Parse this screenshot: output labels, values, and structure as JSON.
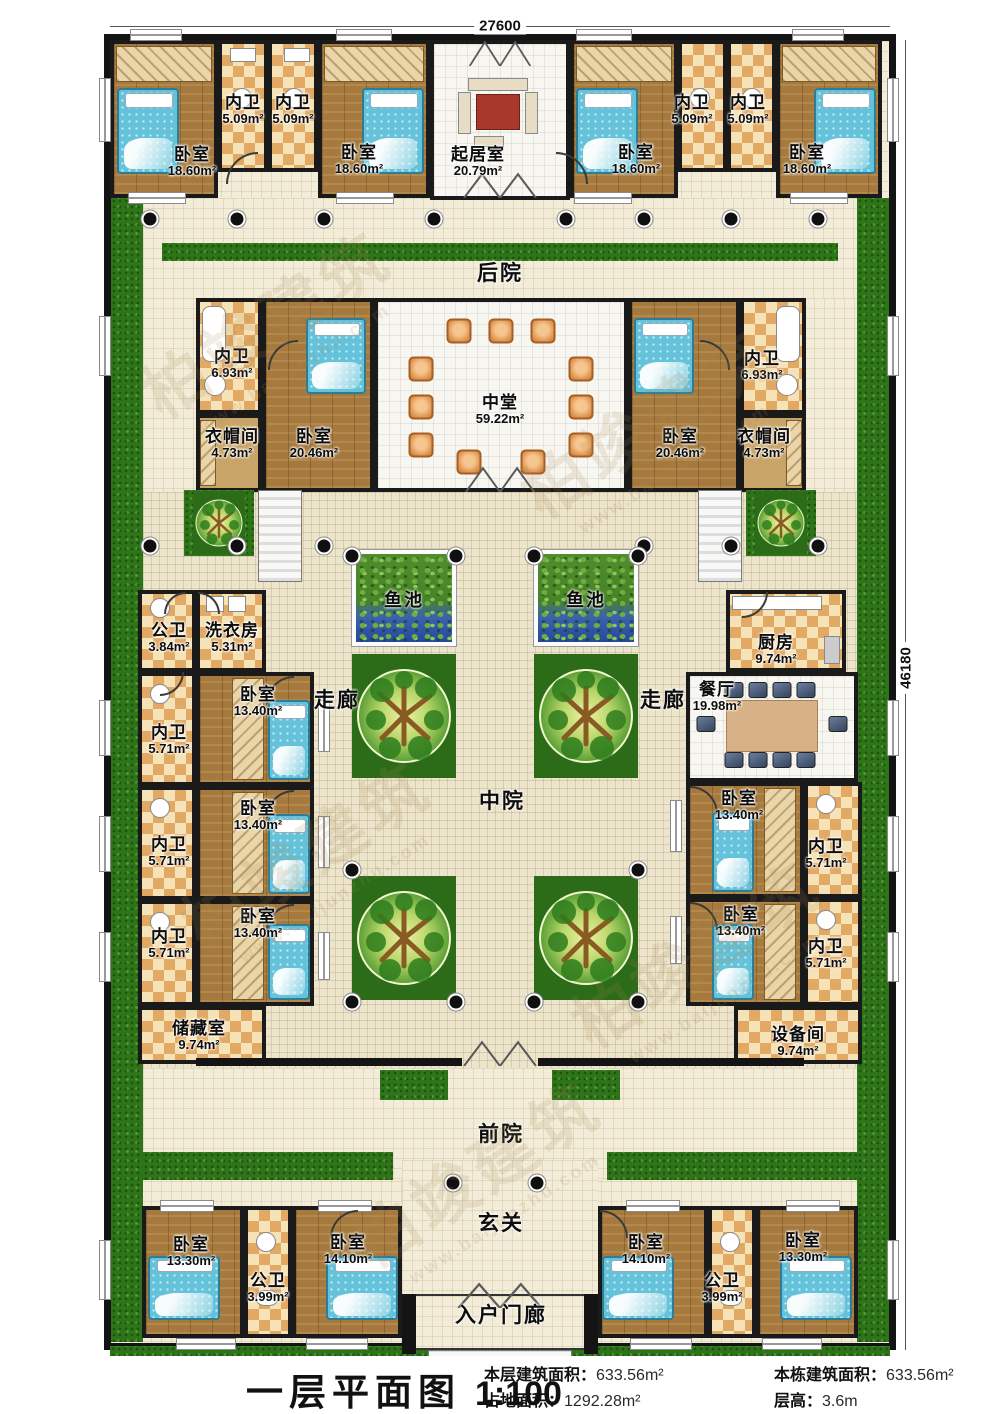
{
  "title": {
    "name": "一层平面图",
    "scale": "1:100"
  },
  "stats": [
    {
      "label": "本层建筑面积：",
      "value": "633.56m²"
    },
    {
      "label": "本栋建筑面积：",
      "value": "633.56m²"
    },
    {
      "label": "占地面积：",
      "value": "1292.28m²"
    },
    {
      "label": "层高：",
      "value": "3.6m"
    }
  ],
  "dimensions": {
    "top": "27600",
    "right": "46180"
  },
  "zones": {
    "backyard": "后院",
    "courtyard": "中院",
    "frontyard": "前院",
    "foyer": "玄关",
    "entry_porch": "入户门廊",
    "corridor_left": "走廊",
    "corridor_right": "走廊",
    "pond_left": "鱼池",
    "pond_right": "鱼池"
  },
  "watermark": {
    "brand": "柏竣建筑",
    "site": "www.baijunzhu.com"
  },
  "rooms": [
    {
      "name": "卧室",
      "area": "18.60m²"
    },
    {
      "name": "内卫",
      "area": "5.09m²"
    },
    {
      "name": "内卫",
      "area": "5.09m²"
    },
    {
      "name": "卧室",
      "area": "18.60m²"
    },
    {
      "name": "起居室",
      "area": "20.79m²"
    },
    {
      "name": "卧室",
      "area": "18.60m²"
    },
    {
      "name": "内卫",
      "area": "5.09m²"
    },
    {
      "name": "内卫",
      "area": "5.09m²"
    },
    {
      "name": "卧室",
      "area": "18.60m²"
    },
    {
      "name": "内卫",
      "area": "6.93m²"
    },
    {
      "name": "衣帽间",
      "area": "4.73m²"
    },
    {
      "name": "卧室",
      "area": "20.46m²"
    },
    {
      "name": "中堂",
      "area": "59.22m²"
    },
    {
      "name": "卧室",
      "area": "20.46m²"
    },
    {
      "name": "内卫",
      "area": "6.93m²"
    },
    {
      "name": "衣帽间",
      "area": "4.73m²"
    },
    {
      "name": "公卫",
      "area": "3.84m²"
    },
    {
      "name": "洗衣房",
      "area": "5.31m²"
    },
    {
      "name": "卧室",
      "area": "13.40m²"
    },
    {
      "name": "内卫",
      "area": "5.71m²"
    },
    {
      "name": "卧室",
      "area": "13.40m²"
    },
    {
      "name": "内卫",
      "area": "5.71m²"
    },
    {
      "name": "卧室",
      "area": "13.40m²"
    },
    {
      "name": "内卫",
      "area": "5.71m²"
    },
    {
      "name": "储藏室",
      "area": "9.74m²"
    },
    {
      "name": "厨房",
      "area": "9.74m²"
    },
    {
      "name": "餐厅",
      "area": "19.98m²"
    },
    {
      "name": "卧室",
      "area": "13.40m²"
    },
    {
      "name": "内卫",
      "area": "5.71m²"
    },
    {
      "name": "卧室",
      "area": "13.40m²"
    },
    {
      "name": "内卫",
      "area": "5.71m²"
    },
    {
      "name": "设备间",
      "area": "9.74m²"
    },
    {
      "name": "卧室",
      "area": "13.30m²"
    },
    {
      "name": "公卫",
      "area": "3.99m²"
    },
    {
      "name": "卧室",
      "area": "14.10m²"
    },
    {
      "name": "卧室",
      "area": "14.10m²"
    },
    {
      "name": "公卫",
      "area": "3.99m²"
    },
    {
      "name": "卧室",
      "area": "13.30m²"
    }
  ]
}
